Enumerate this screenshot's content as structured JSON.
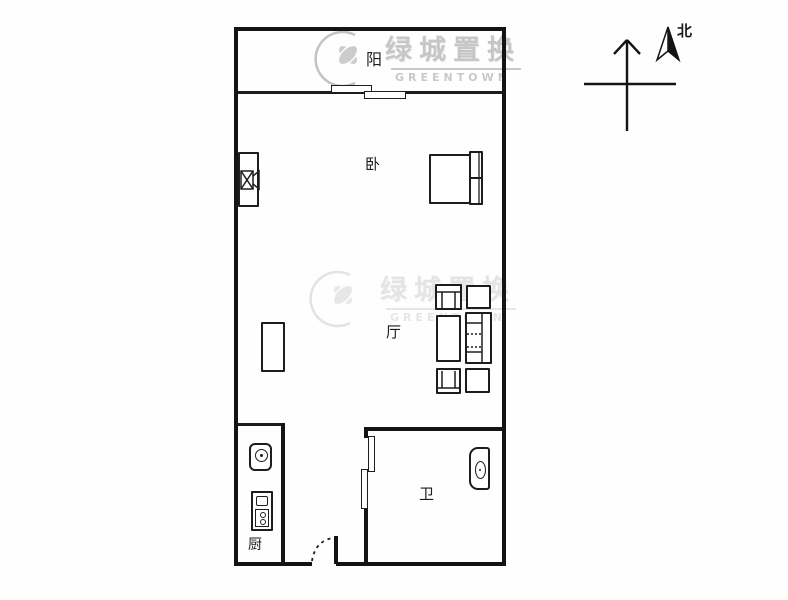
{
  "watermark": {
    "brand_cn": "绿城置换",
    "brand_en": "GREENTOWN"
  },
  "compass": {
    "north_label": "北"
  },
  "rooms": {
    "balcony": {
      "label": "阳"
    },
    "bedroom": {
      "label": "卧"
    },
    "living": {
      "label": "厅"
    },
    "bathroom": {
      "label": "卫"
    },
    "kitchen": {
      "label": "厨"
    }
  },
  "colors": {
    "wall": "#141414",
    "watermark_gray": "#c6c6c6",
    "background": "#fefefe"
  }
}
